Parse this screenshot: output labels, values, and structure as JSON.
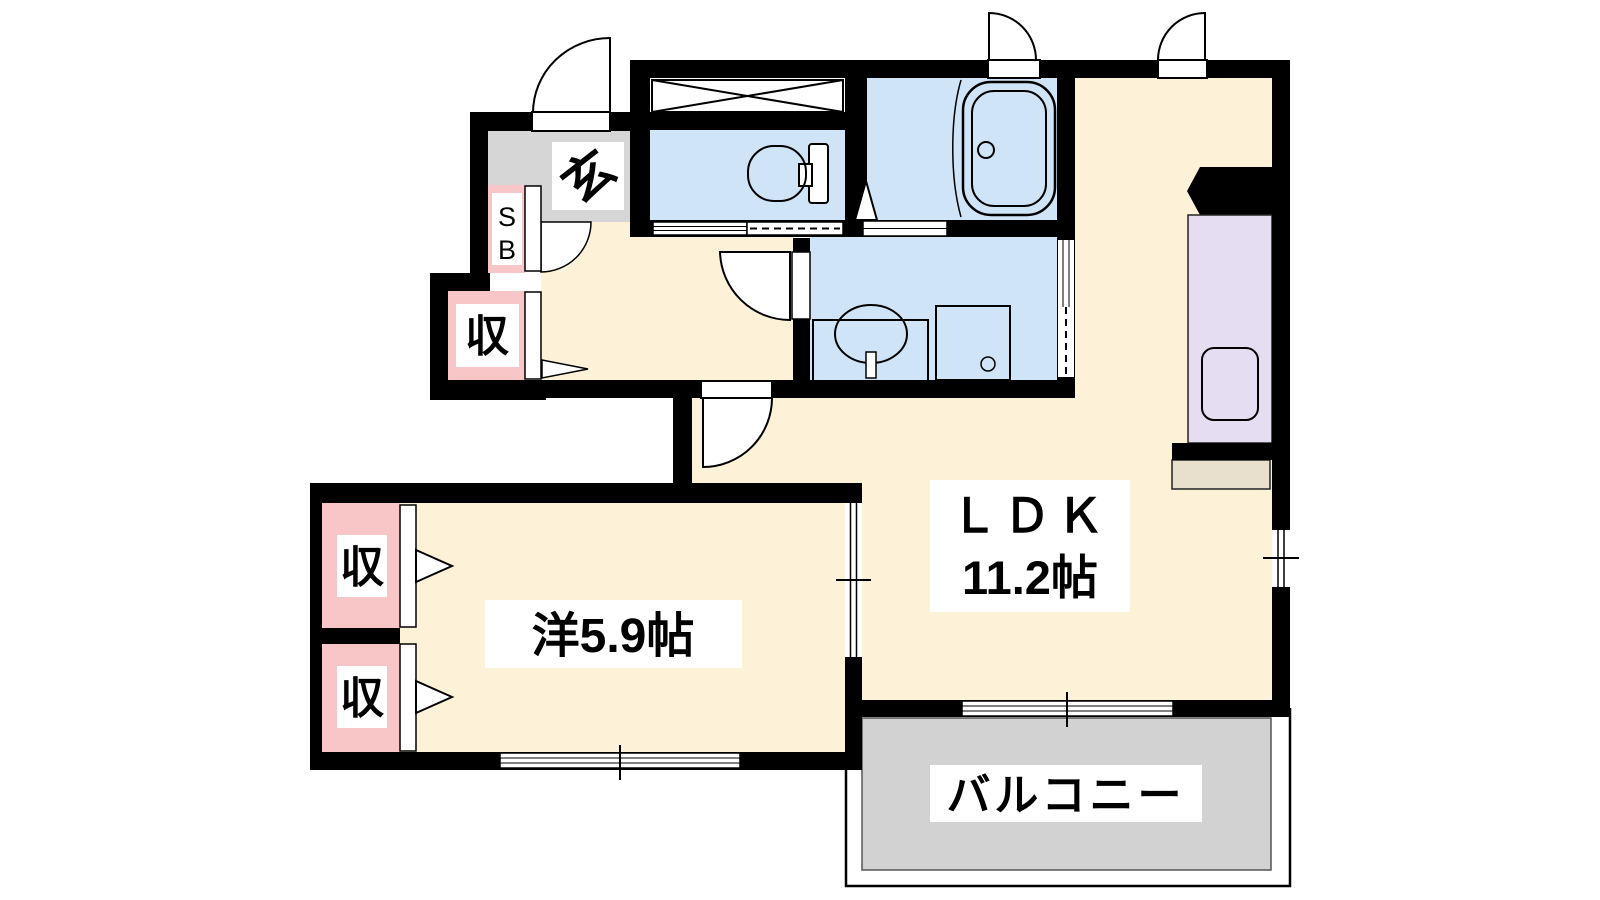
{
  "plan": {
    "type": "apartment-floor-plan",
    "rooms": {
      "entrance": {
        "label": "玄"
      },
      "shoe_box": {
        "letter_top": "S",
        "letter_bottom": "B"
      },
      "closet_entrance": {
        "label": "収"
      },
      "closet_bedroom_upper": {
        "label": "収"
      },
      "closet_bedroom_lower": {
        "label": "収"
      },
      "bedroom": {
        "label": "洋5.9帖"
      },
      "ldk": {
        "name": "ＬＤＫ",
        "size": "11.2帖"
      },
      "balcony": {
        "label": "バルコニー"
      }
    },
    "fixtures": [
      "entrance-door",
      "toilet",
      "storage-x-box",
      "bathtub",
      "vanity-sink",
      "washing-machine-pan",
      "kitchen-counter",
      "kitchen-sink",
      "sliding-windows",
      "balcony-rail"
    ]
  },
  "colors": {
    "floor": "#fdf2d8",
    "wet_area": "#d0e4f7",
    "closet": "#f9c6c8",
    "kitchen_counter": "#e5def2",
    "counter_tan": "#e8e0cc",
    "entrance_floor": "#d6d6d6",
    "balcony_floor": "#d2d2d2",
    "wall": "#000000"
  }
}
